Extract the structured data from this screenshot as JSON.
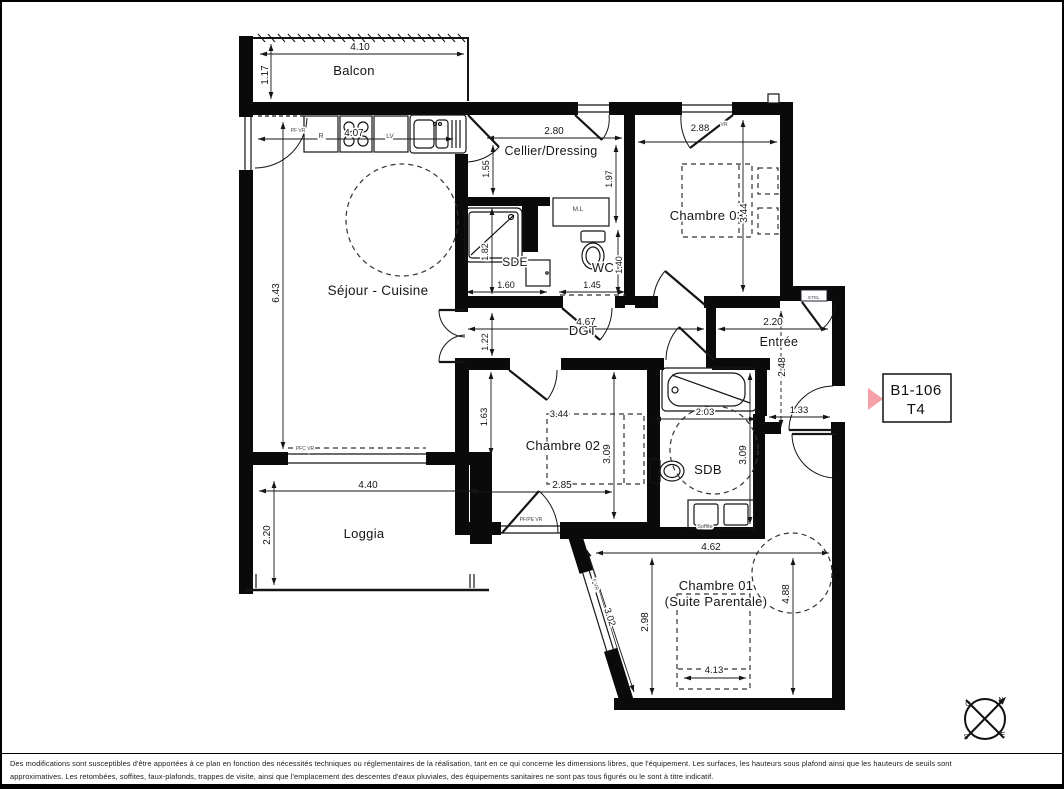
{
  "unit_box": {
    "code": "B1-106",
    "type": "T4"
  },
  "colors": {
    "accent": "#f5a1a7",
    "wall": "#0a0a0a",
    "text": "#151515"
  },
  "compass": {
    "north": "N",
    "south": "S",
    "east": "E",
    "west": "O"
  },
  "plan": {
    "labels": [
      {
        "text": "Balcon",
        "x": 352,
        "y": 73,
        "size": 13,
        "kind": "room"
      },
      {
        "text": "Séjour - Cuisine",
        "x": 376,
        "y": 293,
        "size": 13.5,
        "kind": "room"
      },
      {
        "text": "Cellier/Dressing",
        "x": 549,
        "y": 153,
        "size": 12.5,
        "kind": "room"
      },
      {
        "text": "SDE",
        "x": 513,
        "y": 264,
        "size": 12,
        "kind": "room"
      },
      {
        "text": "WC",
        "x": 601,
        "y": 270,
        "size": 13,
        "kind": "room"
      },
      {
        "text": "Chambre 03",
        "x": 705,
        "y": 218,
        "size": 13,
        "kind": "room"
      },
      {
        "text": "DGT",
        "x": 581,
        "y": 333,
        "size": 13,
        "kind": "room"
      },
      {
        "text": "Entrée",
        "x": 777,
        "y": 344,
        "size": 12.5,
        "kind": "room"
      },
      {
        "text": "Chambre 02",
        "x": 561,
        "y": 448,
        "size": 13,
        "kind": "room"
      },
      {
        "text": "SDB",
        "x": 706,
        "y": 472,
        "size": 13,
        "kind": "room"
      },
      {
        "text": "Loggia",
        "x": 362,
        "y": 536,
        "size": 13,
        "kind": "room"
      },
      {
        "text": "Chambre 01",
        "x": 714,
        "y": 588,
        "size": 13,
        "kind": "room"
      },
      {
        "text": "(Suite Parentale)",
        "x": 714,
        "y": 604,
        "size": 13,
        "kind": "room"
      },
      {
        "text": "4.10",
        "x": 358,
        "y": 48,
        "size": 10,
        "kind": "dim"
      },
      {
        "text": "1.17",
        "x": 266,
        "y": 73,
        "size": 10,
        "rot": -90,
        "kind": "dim"
      },
      {
        "text": "4.07",
        "x": 352,
        "y": 134,
        "size": 10,
        "kind": "dim"
      },
      {
        "text": "6.43",
        "x": 277,
        "y": 291,
        "size": 10,
        "rot": -90,
        "kind": "dim"
      },
      {
        "text": "2.80",
        "x": 552,
        "y": 132,
        "size": 10,
        "kind": "dim"
      },
      {
        "text": "1.55",
        "x": 487,
        "y": 167,
        "size": 9,
        "rot": -90,
        "kind": "dim"
      },
      {
        "text": "1.97",
        "x": 610,
        "y": 177,
        "size": 9,
        "rot": -90,
        "kind": "dim"
      },
      {
        "text": "1.82",
        "x": 486,
        "y": 250,
        "size": 9,
        "rot": -90,
        "kind": "dim"
      },
      {
        "text": "1.60",
        "x": 504,
        "y": 286,
        "size": 9,
        "kind": "dim"
      },
      {
        "text": "1.45",
        "x": 590,
        "y": 286,
        "size": 9,
        "kind": "dim"
      },
      {
        "text": "1.40",
        "x": 620,
        "y": 263,
        "size": 9,
        "rot": -90,
        "kind": "dim"
      },
      {
        "text": "2.88",
        "x": 698,
        "y": 129,
        "size": 9.5,
        "kind": "dim"
      },
      {
        "text": "3.44",
        "x": 745,
        "y": 211,
        "size": 10,
        "rot": -90,
        "kind": "dim"
      },
      {
        "text": "4.67",
        "x": 584,
        "y": 323,
        "size": 10,
        "kind": "dim"
      },
      {
        "text": "1.22",
        "x": 486,
        "y": 340,
        "size": 9,
        "rot": -90,
        "kind": "dim"
      },
      {
        "text": "2.20",
        "x": 771,
        "y": 323,
        "size": 10,
        "kind": "dim"
      },
      {
        "text": "2.48",
        "x": 783,
        "y": 365,
        "size": 10,
        "rot": -90,
        "kind": "dim"
      },
      {
        "text": "1.33",
        "x": 797,
        "y": 411,
        "size": 9.5,
        "kind": "dim"
      },
      {
        "text": "1.63",
        "x": 485,
        "y": 415,
        "size": 9.5,
        "rot": -90,
        "kind": "dim"
      },
      {
        "text": "3.44",
        "x": 557,
        "y": 415,
        "size": 9.5,
        "kind": "dim"
      },
      {
        "text": "3.09",
        "x": 608,
        "y": 452,
        "size": 10,
        "rot": -90,
        "kind": "dim"
      },
      {
        "text": "2.85",
        "x": 560,
        "y": 486,
        "size": 10,
        "kind": "dim"
      },
      {
        "text": "2.03",
        "x": 703,
        "y": 413,
        "size": 9.5,
        "kind": "dim"
      },
      {
        "text": "3.09",
        "x": 744,
        "y": 453,
        "size": 10,
        "rot": -90,
        "kind": "dim"
      },
      {
        "text": "4.40",
        "x": 366,
        "y": 486,
        "size": 10,
        "kind": "dim"
      },
      {
        "text": "2.20",
        "x": 268,
        "y": 533,
        "size": 10,
        "rot": -90,
        "kind": "dim"
      },
      {
        "text": "4.62",
        "x": 709,
        "y": 548,
        "size": 10,
        "kind": "dim"
      },
      {
        "text": "4.88",
        "x": 787,
        "y": 592,
        "size": 10,
        "rot": -90,
        "kind": "dim"
      },
      {
        "text": "2.98",
        "x": 646,
        "y": 620,
        "size": 10,
        "rot": -90,
        "kind": "dim"
      },
      {
        "text": "3.02",
        "x": 605,
        "y": 616,
        "size": 9.5,
        "rot": 72,
        "kind": "dim"
      },
      {
        "text": "4.13",
        "x": 712,
        "y": 671,
        "size": 9.5,
        "kind": "dim"
      },
      {
        "text": "PF VR",
        "x": 296,
        "y": 130,
        "size": 5,
        "kind": "annot"
      },
      {
        "text": "R",
        "x": 319,
        "y": 136,
        "size": 7,
        "kind": "annot"
      },
      {
        "text": "LV",
        "x": 388,
        "y": 136,
        "size": 6.5,
        "kind": "annot"
      },
      {
        "text": "M.L",
        "x": 576,
        "y": 209,
        "size": 6.5,
        "kind": "annot"
      },
      {
        "text": "ETEL",
        "x": 812,
        "y": 297,
        "size": 4.6,
        "kind": "annot"
      },
      {
        "text": "PFC VR",
        "x": 303,
        "y": 448,
        "size": 5,
        "kind": "annot"
      },
      {
        "text": "PF/PE VR",
        "x": 529,
        "y": 519,
        "size": 5,
        "kind": "annot"
      },
      {
        "text": "F VR",
        "x": 592,
        "y": 583,
        "size": 5,
        "rot": 72,
        "kind": "annot"
      },
      {
        "text": "VR",
        "x": 722,
        "y": 124,
        "size": 5,
        "kind": "annot"
      },
      {
        "text": "Soffite",
        "x": 703,
        "y": 526,
        "size": 5.5,
        "kind": "annot"
      }
    ]
  },
  "disclaimer": {
    "line1": "Des modifications sont susceptibles d'être apportées à ce plan en fonction des nécessités techniques ou réglementaires de la réalisation, tant en ce qui concerne les dimensions libres, que l'équipement. Les surfaces, les hauteurs sous plafond ainsi que les hauteurs de seuils sont",
    "line2": "approximatives. Les retombées, soffites, faux-plafonds, trappes de visite, ainsi que l'emplacement des descentes d'eaux pluviales, des équipements sanitaires ne sont pas tous figurés ou le sont à titre indicatif."
  }
}
